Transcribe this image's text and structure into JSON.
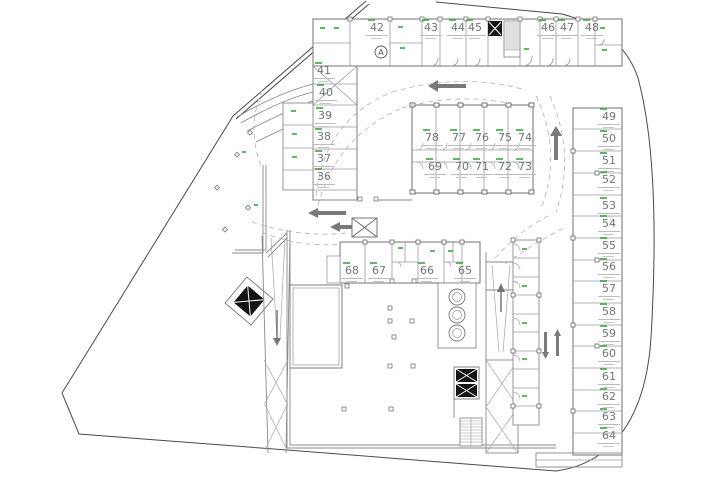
{
  "plan": {
    "type": "underground-parking-storage-floor-plan",
    "units": {
      "top_band": [
        "42",
        "43",
        "44",
        "45",
        "46",
        "47",
        "48"
      ],
      "left_column": [
        "41",
        "40",
        "39",
        "38",
        "37",
        "36"
      ],
      "island_top": [
        "78",
        "77",
        "76",
        "75",
        "74"
      ],
      "island_bottom": [
        "69",
        "70",
        "71",
        "72",
        "73"
      ],
      "right_column": [
        "49",
        "50",
        "51",
        "52",
        "53",
        "54",
        "55",
        "56",
        "57",
        "58",
        "59",
        "60",
        "61",
        "62",
        "63",
        "64"
      ],
      "bottom_row": [
        "68",
        "67",
        "66",
        "65"
      ]
    },
    "annotation_a": "A",
    "symbols": [
      "elevator-shaft",
      "stairs",
      "ramp",
      "storage-tanks",
      "column-grid",
      "drive-path-arrows"
    ],
    "colors": {
      "unit_number": "#6e7872",
      "micro_label_green": "#3fae49",
      "walls": "#7d7d7d",
      "boundary": "#4a4a4a",
      "background": "#ffffff"
    }
  }
}
